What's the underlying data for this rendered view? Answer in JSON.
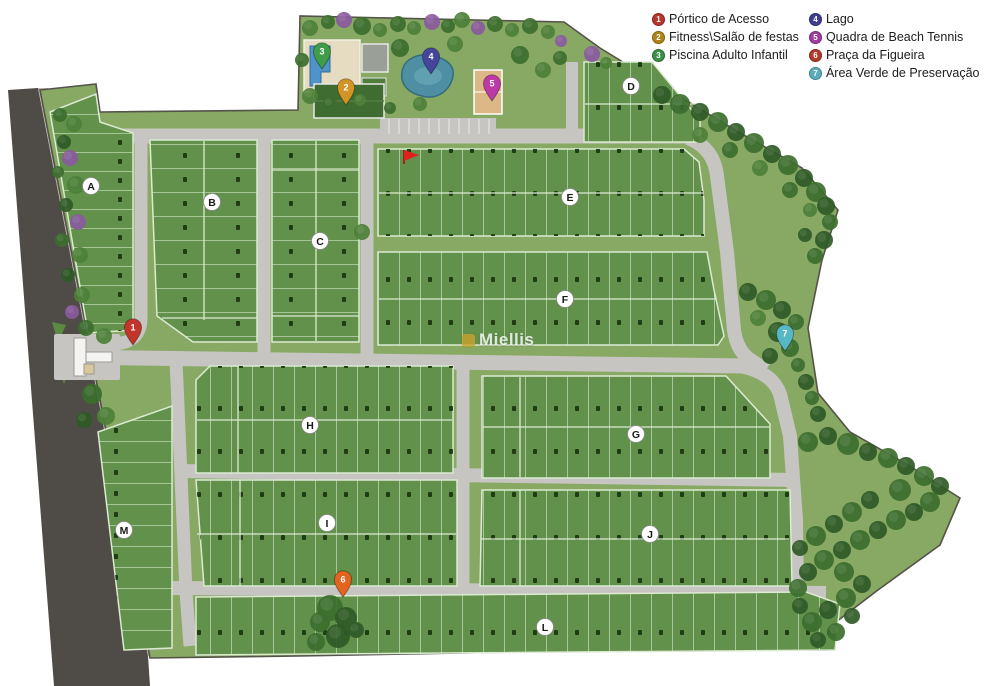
{
  "legend": {
    "columns": [
      [
        {
          "number": "1",
          "label": "Pórtico de Acesso",
          "color": "#b5362c"
        },
        {
          "number": "2",
          "label": "Fitness\\Salão de festas",
          "color": "#b08419"
        },
        {
          "number": "3",
          "label": "Piscina Adulto Infantil",
          "color": "#3c9047"
        }
      ],
      [
        {
          "number": "4",
          "label": "Lago",
          "color": "#3f3f90"
        },
        {
          "number": "5",
          "label": "Quadra de Beach Tennis",
          "color": "#a03da0"
        },
        {
          "number": "6",
          "label": "Praça da Figueira",
          "color": "#b03a2e"
        },
        {
          "number": "7",
          "label": "Área Verde de Preservação",
          "color": "#5aaebc"
        }
      ]
    ]
  },
  "watermark": {
    "text": "Miellis"
  },
  "map": {
    "background": "#ffffff",
    "grass": "#87a963",
    "block_fill": "#61914a",
    "lot_line": "#dcead2",
    "road": "#c6c5c1",
    "outer_road": "#4f4b47",
    "boundary": "#55524a",
    "blocks": [
      {
        "letter": "A",
        "x": 91,
        "y": 186
      },
      {
        "letter": "B",
        "x": 212,
        "y": 202
      },
      {
        "letter": "C",
        "x": 320,
        "y": 241
      },
      {
        "letter": "D",
        "x": 631,
        "y": 86
      },
      {
        "letter": "E",
        "x": 570,
        "y": 197
      },
      {
        "letter": "F",
        "x": 565,
        "y": 299
      },
      {
        "letter": "G",
        "x": 636,
        "y": 434
      },
      {
        "letter": "H",
        "x": 310,
        "y": 425
      },
      {
        "letter": "I",
        "x": 327,
        "y": 523
      },
      {
        "letter": "J",
        "x": 650,
        "y": 534
      },
      {
        "letter": "L",
        "x": 545,
        "y": 627
      },
      {
        "letter": "M",
        "x": 124,
        "y": 530
      }
    ],
    "pins": [
      {
        "number": "1",
        "x": 133,
        "y": 344,
        "color": "#c3342b"
      },
      {
        "number": "2",
        "x": 346,
        "y": 104,
        "color": "#d29327"
      },
      {
        "number": "3",
        "x": 322,
        "y": 68,
        "color": "#3f9d49"
      },
      {
        "number": "4",
        "x": 431,
        "y": 73,
        "color": "#44459b"
      },
      {
        "number": "5",
        "x": 492,
        "y": 100,
        "color": "#bb3aa5"
      },
      {
        "number": "6",
        "x": 343,
        "y": 596,
        "color": "#e2641f"
      },
      {
        "number": "7",
        "x": 785,
        "y": 350,
        "color": "#58b7c5"
      }
    ],
    "flag": {
      "x": 404,
      "y": 150,
      "color": "#e0201a"
    },
    "tree_colors": [
      "#2f5a26",
      "#3c6e2e",
      "#4d8038",
      "#8a5a9e"
    ],
    "trees": [
      [
        60,
        115,
        7,
        1
      ],
      [
        74,
        124,
        8,
        2
      ],
      [
        64,
        142,
        7,
        0
      ],
      [
        70,
        158,
        8,
        3
      ],
      [
        58,
        172,
        6,
        1
      ],
      [
        76,
        185,
        9,
        2
      ],
      [
        66,
        205,
        7,
        0
      ],
      [
        78,
        222,
        8,
        3
      ],
      [
        62,
        240,
        7,
        1
      ],
      [
        80,
        255,
        8,
        2
      ],
      [
        68,
        275,
        7,
        0
      ],
      [
        82,
        295,
        8,
        2
      ],
      [
        72,
        312,
        7,
        3
      ],
      [
        86,
        328,
        8,
        1
      ],
      [
        104,
        336,
        8,
        2
      ],
      [
        92,
        394,
        10,
        1
      ],
      [
        106,
        416,
        9,
        2
      ],
      [
        84,
        420,
        8,
        0
      ],
      [
        310,
        28,
        8,
        2
      ],
      [
        328,
        22,
        7,
        1
      ],
      [
        344,
        20,
        8,
        3
      ],
      [
        362,
        26,
        9,
        1
      ],
      [
        380,
        30,
        7,
        2
      ],
      [
        398,
        24,
        8,
        1
      ],
      [
        414,
        28,
        7,
        2
      ],
      [
        432,
        22,
        8,
        3
      ],
      [
        448,
        26,
        7,
        1
      ],
      [
        462,
        20,
        8,
        2
      ],
      [
        478,
        28,
        7,
        3
      ],
      [
        495,
        24,
        8,
        1
      ],
      [
        512,
        30,
        7,
        2
      ],
      [
        530,
        26,
        8,
        1
      ],
      [
        548,
        32,
        7,
        2
      ],
      [
        561,
        41,
        6,
        3
      ],
      [
        592,
        54,
        8,
        3
      ],
      [
        606,
        63,
        6,
        2
      ],
      [
        400,
        48,
        9,
        1
      ],
      [
        455,
        44,
        8,
        2
      ],
      [
        520,
        55,
        9,
        1
      ],
      [
        543,
        70,
        8,
        2
      ],
      [
        560,
        58,
        7,
        1
      ],
      [
        310,
        96,
        8,
        2
      ],
      [
        330,
        104,
        7,
        1
      ],
      [
        360,
        100,
        6,
        2
      ],
      [
        390,
        108,
        6,
        1
      ],
      [
        420,
        104,
        7,
        2
      ],
      [
        302,
        60,
        7,
        1
      ],
      [
        362,
        232,
        8,
        2
      ],
      [
        662,
        95,
        9,
        0
      ],
      [
        680,
        104,
        10,
        1
      ],
      [
        700,
        112,
        9,
        0
      ],
      [
        718,
        122,
        10,
        1
      ],
      [
        736,
        132,
        9,
        0
      ],
      [
        754,
        143,
        10,
        1
      ],
      [
        772,
        154,
        9,
        0
      ],
      [
        788,
        165,
        10,
        1
      ],
      [
        804,
        178,
        9,
        0
      ],
      [
        816,
        192,
        10,
        1
      ],
      [
        826,
        206,
        9,
        0
      ],
      [
        830,
        222,
        8,
        1
      ],
      [
        824,
        240,
        9,
        0
      ],
      [
        815,
        256,
        8,
        1
      ],
      [
        700,
        135,
        8,
        2
      ],
      [
        730,
        150,
        8,
        1
      ],
      [
        760,
        168,
        8,
        2
      ],
      [
        790,
        190,
        8,
        1
      ],
      [
        810,
        210,
        7,
        2
      ],
      [
        805,
        235,
        7,
        0
      ],
      [
        748,
        292,
        9,
        0
      ],
      [
        766,
        300,
        10,
        1
      ],
      [
        782,
        310,
        9,
        0
      ],
      [
        796,
        322,
        8,
        1
      ],
      [
        778,
        332,
        10,
        0
      ],
      [
        758,
        318,
        8,
        2
      ],
      [
        790,
        348,
        9,
        1
      ],
      [
        770,
        356,
        8,
        0
      ],
      [
        798,
        365,
        7,
        1
      ],
      [
        806,
        382,
        8,
        0
      ],
      [
        812,
        398,
        7,
        1
      ],
      [
        818,
        414,
        8,
        0
      ],
      [
        808,
        442,
        10,
        1
      ],
      [
        828,
        436,
        9,
        0
      ],
      [
        848,
        444,
        11,
        1
      ],
      [
        868,
        452,
        9,
        0
      ],
      [
        888,
        458,
        10,
        1
      ],
      [
        906,
        466,
        9,
        0
      ],
      [
        924,
        476,
        10,
        1
      ],
      [
        940,
        486,
        9,
        0
      ],
      [
        930,
        502,
        10,
        1
      ],
      [
        914,
        512,
        9,
        0
      ],
      [
        896,
        520,
        10,
        1
      ],
      [
        878,
        530,
        9,
        0
      ],
      [
        860,
        540,
        10,
        1
      ],
      [
        842,
        550,
        9,
        0
      ],
      [
        824,
        560,
        10,
        1
      ],
      [
        808,
        572,
        9,
        0
      ],
      [
        844,
        572,
        10,
        1
      ],
      [
        862,
        584,
        9,
        0
      ],
      [
        846,
        598,
        10,
        1
      ],
      [
        828,
        610,
        9,
        0
      ],
      [
        812,
        622,
        10,
        1
      ],
      [
        852,
        616,
        8,
        0
      ],
      [
        836,
        632,
        9,
        1
      ],
      [
        818,
        640,
        8,
        0
      ],
      [
        900,
        490,
        11,
        1
      ],
      [
        870,
        500,
        9,
        0
      ],
      [
        852,
        512,
        10,
        1
      ],
      [
        834,
        524,
        9,
        0
      ],
      [
        816,
        536,
        10,
        1
      ],
      [
        800,
        548,
        8,
        0
      ],
      [
        798,
        588,
        9,
        1
      ],
      [
        800,
        606,
        8,
        0
      ],
      [
        330,
        608,
        13,
        1
      ],
      [
        346,
        618,
        11,
        0
      ],
      [
        320,
        622,
        10,
        1
      ],
      [
        338,
        636,
        12,
        0
      ],
      [
        316,
        642,
        9,
        1
      ],
      [
        356,
        630,
        8,
        0
      ]
    ]
  }
}
